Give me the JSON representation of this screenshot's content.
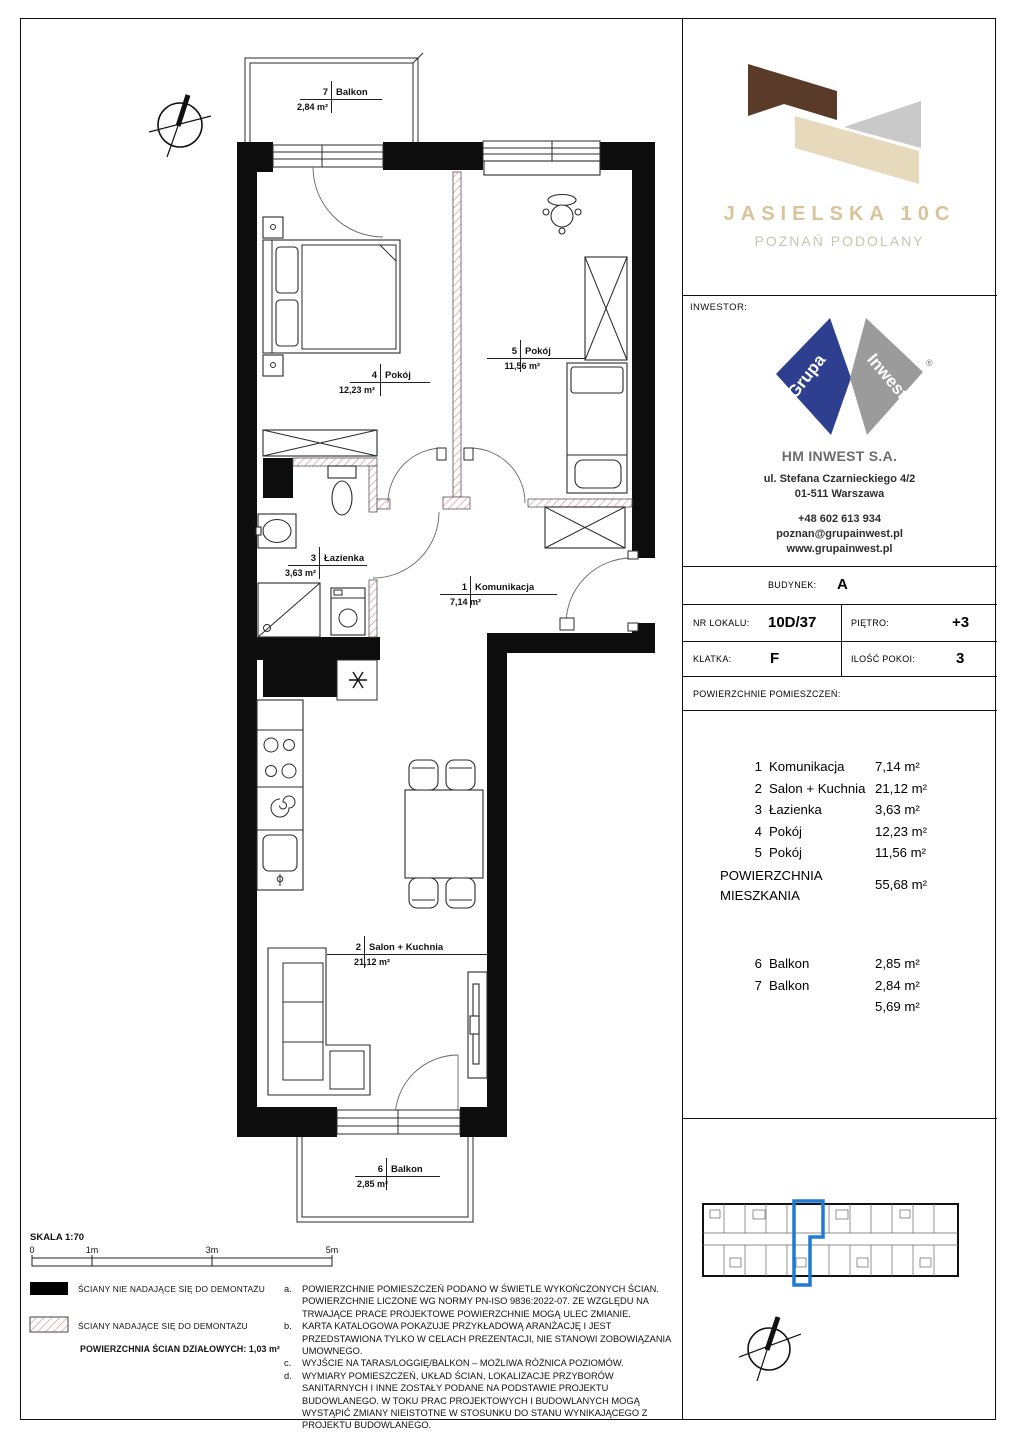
{
  "project": {
    "name": "JASIELSKA 10C",
    "location": "POZNAŃ PODOLANY"
  },
  "investor": {
    "section_label": "INWESTOR:",
    "logo_left": "Grupa",
    "logo_right": "Inwest",
    "logo_reg": "®",
    "company": "HM INWEST S.A.",
    "address_line1": "ul. Stefana Czarnieckiego 4/2",
    "address_line2": "01-511 Warszawa",
    "phone": "+48 602 613 934",
    "email": "poznan@grupainwest.pl",
    "website": "www.grupainwest.pl"
  },
  "unit_info": {
    "budynek_label": "BUDYNEK:",
    "budynek": "A",
    "nr_lokalu_label": "NR LOKALU:",
    "nr_lokalu": "10D/37",
    "pietro_label": "PIĘTRO:",
    "pietro": "+3",
    "klatka_label": "KLATKA:",
    "klatka": "F",
    "ilosc_pokoi_label": "ILOŚĆ POKOI:",
    "ilosc_pokoi": "3",
    "areas_header": "POWIERZCHNIE POMIESZCZEŃ:"
  },
  "areas": {
    "rooms": [
      {
        "no": "1",
        "name": "Komunikacja",
        "area": "7,14 m²"
      },
      {
        "no": "2",
        "name": "Salon + Kuchnia",
        "area": "21,12 m²"
      },
      {
        "no": "3",
        "name": "Łazienka",
        "area": "3,63 m²"
      },
      {
        "no": "4",
        "name": "Pokój",
        "area": "12,23 m²"
      },
      {
        "no": "5",
        "name": "Pokój",
        "area": "11,56 m²"
      }
    ],
    "total_label_line1": "POWIERZCHNIA",
    "total_label_line2": "MIESZKANIA",
    "total": "55,68 m²",
    "balconies": [
      {
        "no": "6",
        "name": "Balkon",
        "area": "2,85 m²"
      },
      {
        "no": "7",
        "name": "Balkon",
        "area": "2,84 m²"
      }
    ],
    "balconies_total": "5,69 m²"
  },
  "plan": {
    "rooms": [
      {
        "no": "7",
        "name": "Balkon",
        "area": "2,84 m²"
      },
      {
        "no": "4",
        "name": "Pokój",
        "area": "12,23 m²"
      },
      {
        "no": "5",
        "name": "Pokój",
        "area": "11,56 m²"
      },
      {
        "no": "3",
        "name": "Łazienka",
        "area": "3,63 m²"
      },
      {
        "no": "1",
        "name": "Komunikacja",
        "area": "7,14 m²"
      },
      {
        "no": "2",
        "name": "Salon + Kuchnia",
        "area": "21,12 m²"
      },
      {
        "no": "6",
        "name": "Balkon",
        "area": "2,85 m²"
      }
    ]
  },
  "scale": {
    "label": "SKALA 1:70",
    "ticks": [
      "0",
      "1m",
      "3m",
      "5m"
    ]
  },
  "legend": {
    "solid_label": "ŚCIANY NIE NADAJĄCE SIĘ DO DEMONTAŻU",
    "hatched_label": "ŚCIANY NADAJĄCE SIĘ DO DEMONTAŻU",
    "partition_label": "POWIERZCHNIA ŚCIAN DZIAŁOWYCH: 1,03 m²"
  },
  "notes": [
    {
      "id": "a.",
      "text": "POWIERZCHNIE POMIESZCZEŃ PODANO W ŚWIETLE WYKOŃCZONYCH ŚCIAN. POWIERZCHNIE LICZONE WG NORMY PN-ISO 9836:2022-07. ZE WZGLĘDU NA TRWAJĄCE PRACE PROJEKTOWE POWIERZCHNIE MOGĄ ULEC ZMIANIE."
    },
    {
      "id": "b.",
      "text": "KARTA KATALOGOWA POKAZUJE PRZYKŁADOWĄ ARANŻACJĘ I JEST PRZEDSTAWIONA TYLKO W CELACH PREZENTACJI, NIE STANOWI ZOBOWIĄZANIA UMOWNEGO."
    },
    {
      "id": "c.",
      "text": "WYJŚCIE NA TARAS/LOGGIĘ/BALKON – MOŻLIWA RÓŻNICA POZIOMÓW."
    },
    {
      "id": "d.",
      "text": "WYMIARY POMIESZCZEŃ, UKŁAD ŚCIAN, LOKALIZACJE PRZYBORÓW SANITARNYCH I INNE ZOSTAŁY PODANE NA PODSTAWIE PROJEKTU BUDOWLANEGO. W TOKU PRAC PROJEKTOWYCH I BUDOWLANYCH MOGĄ WYSTĄPIĆ ZMIANY NIEISTOTNE W STOSUNKU DO STANU WYNIKAJĄCEGO Z PROJEKTU BUDOWLANEGO."
    }
  ],
  "colors": {
    "brand_title": "#d8c39a",
    "brand_sub": "#ccc4ad",
    "logo_brown": "#5a3a28",
    "logo_beige": "#e7d9bb",
    "logo_gray": "#c9c9c9",
    "inwest_blue": "#2d3f8e",
    "inwest_gray": "#9b9b9b",
    "company_gray": "#6d6d6d",
    "wall_hatch_red": "#e08383",
    "unit_highlight_blue": "#1f7ad4"
  }
}
